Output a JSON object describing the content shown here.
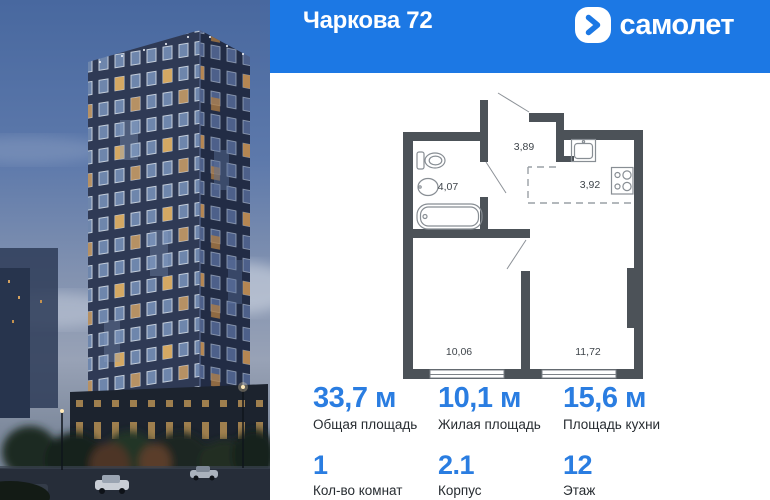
{
  "header": {
    "title": "Чаркова 72",
    "logo_text": "самолет"
  },
  "floor_plan": {
    "rooms": [
      {
        "name": "bathroom",
        "area": "4,07"
      },
      {
        "name": "hallway",
        "area": "3,89"
      },
      {
        "name": "kitchen",
        "area": "3,92"
      },
      {
        "name": "bedroom",
        "area": "10,06"
      },
      {
        "name": "living-room",
        "area": "11,72"
      }
    ]
  },
  "stats": {
    "row1": [
      {
        "value": "33,7 м",
        "label": "Общая площадь"
      },
      {
        "value": "10,1 м",
        "label": "Жилая площадь"
      },
      {
        "value": "15,6 м",
        "label": "Площадь кухни"
      }
    ],
    "row2": [
      {
        "value": "1",
        "label": "Кол-во комнат"
      },
      {
        "value": "2.1",
        "label": "Корпус"
      },
      {
        "value": "12",
        "label": "Этаж"
      }
    ]
  },
  "colors": {
    "brand_blue": "#1c78e4",
    "accent_blue": "#2a7de1",
    "plan_wall": "#4c5258",
    "label_dark": "#272c31"
  }
}
